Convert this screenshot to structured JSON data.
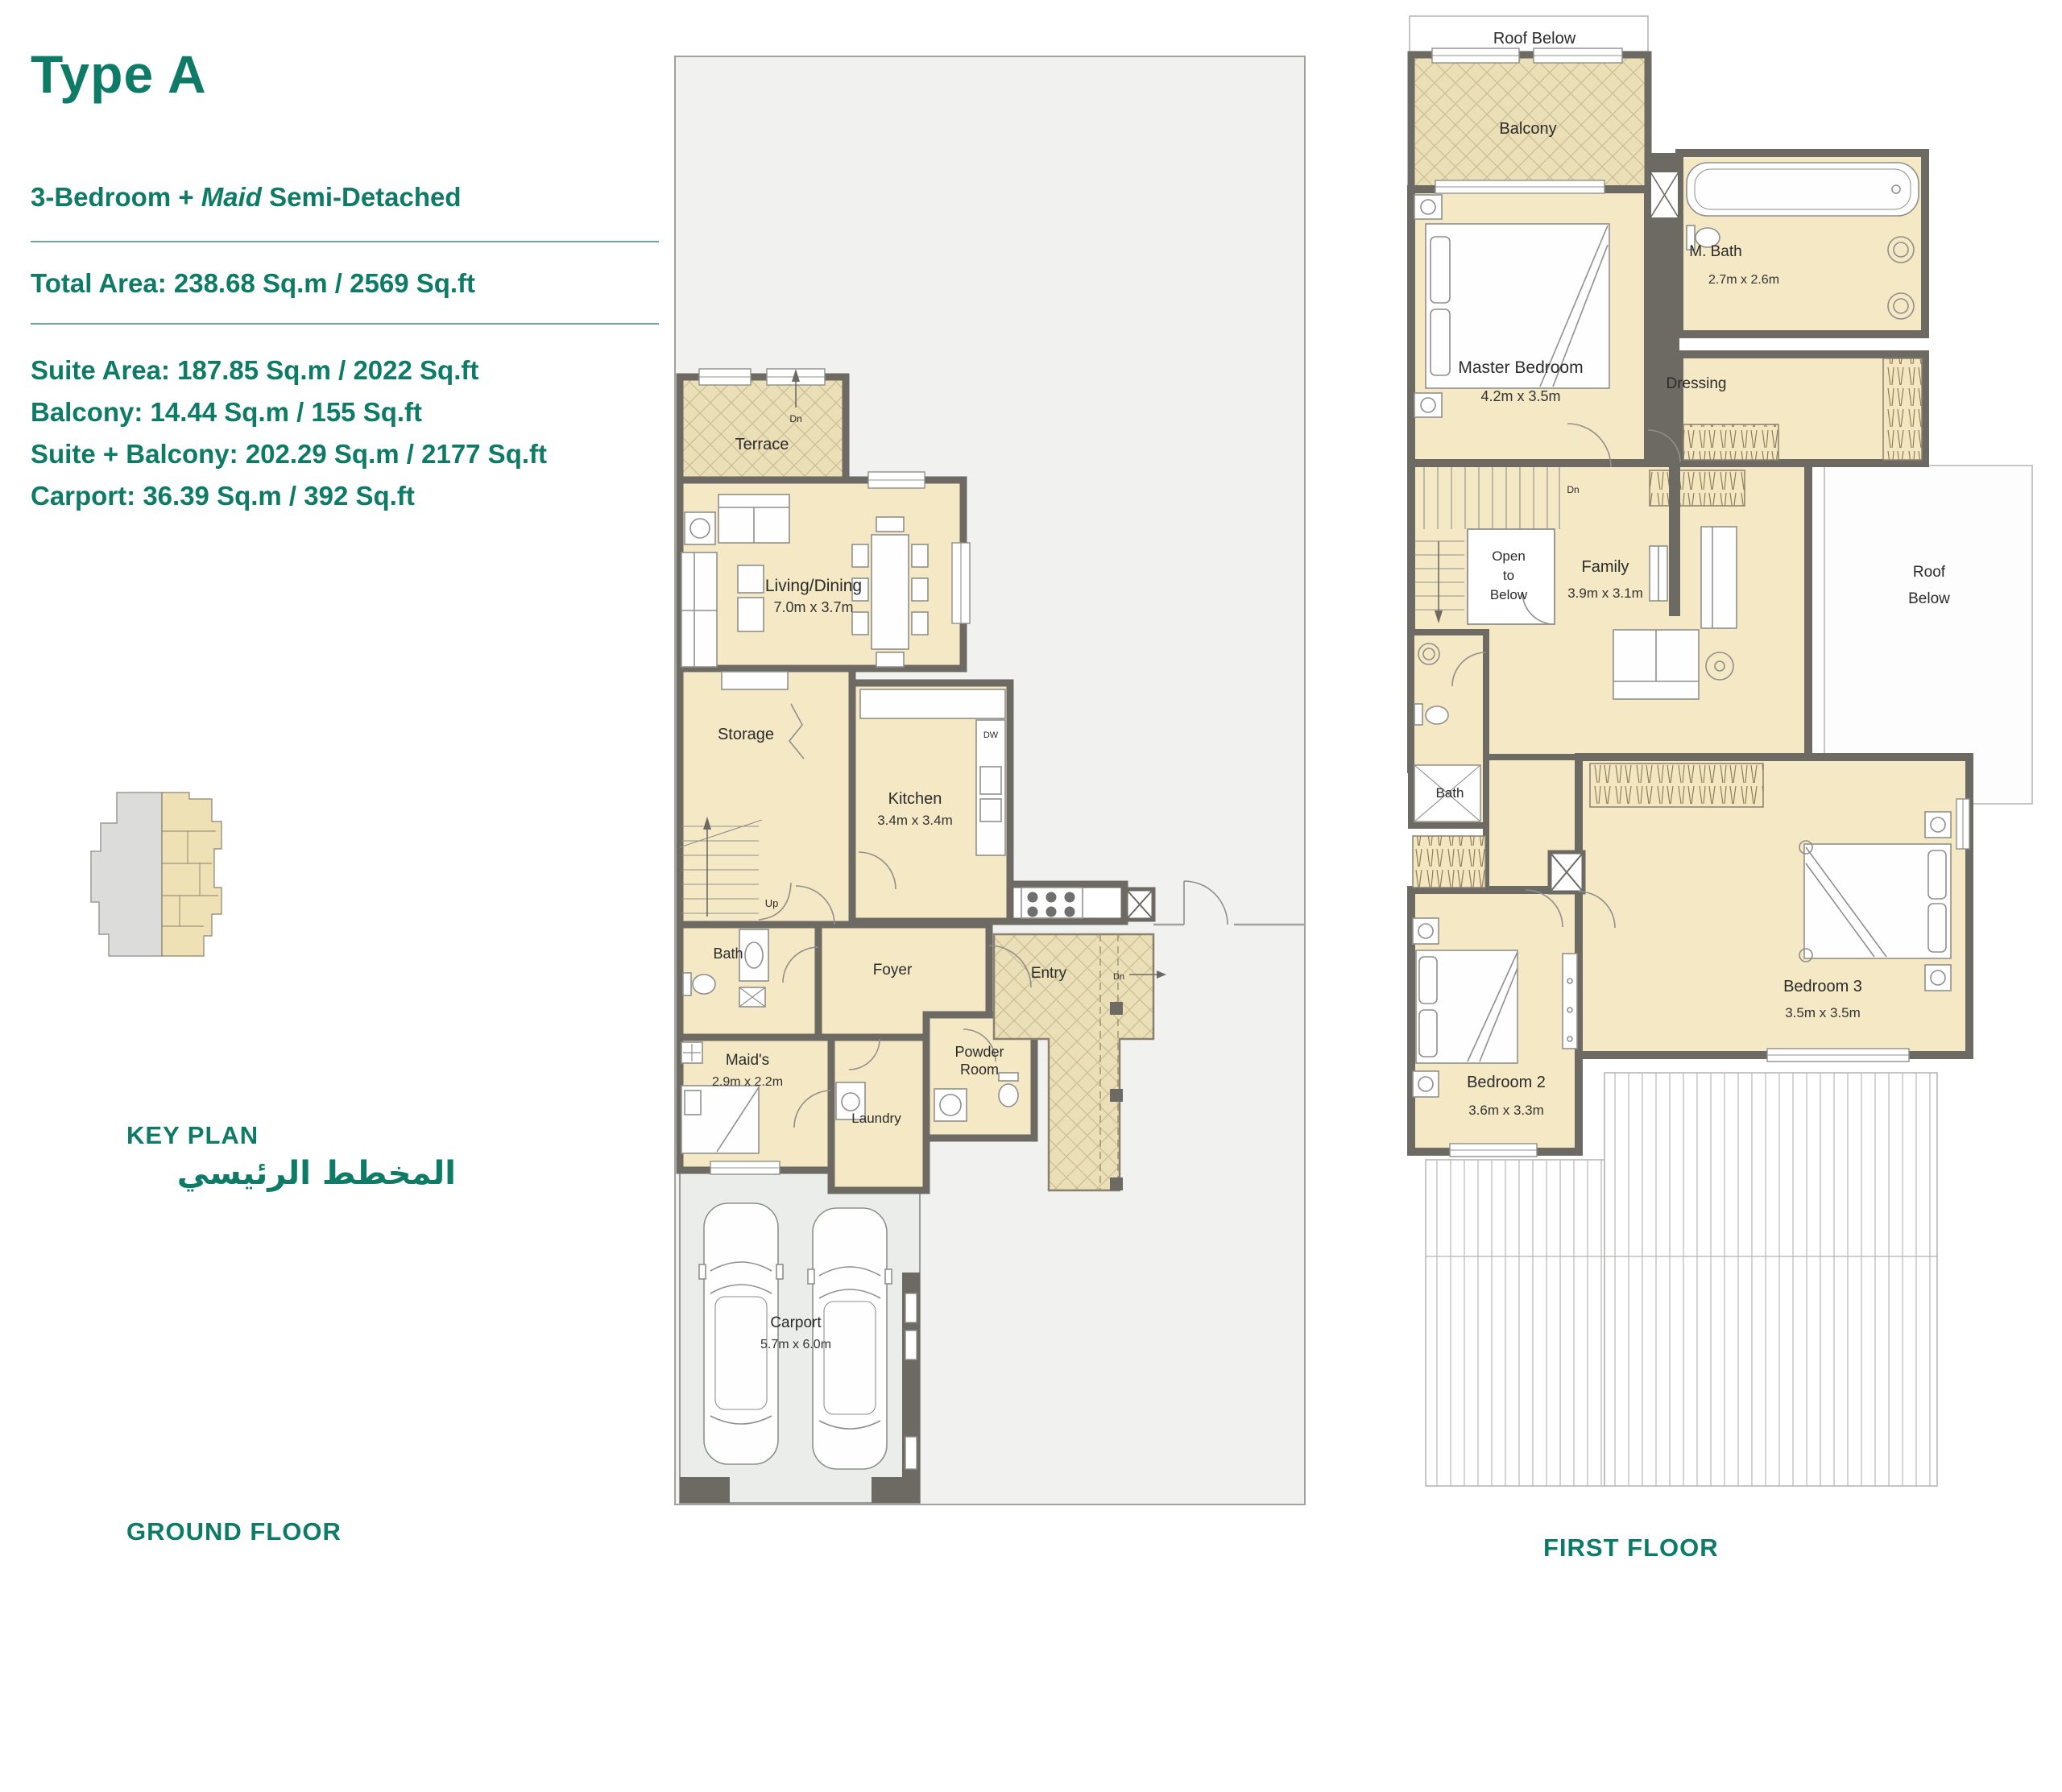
{
  "header": {
    "title": "Type A",
    "subtitle_prefix": "3-Bedroom + ",
    "subtitle_italic": "Maid",
    "subtitle_suffix": " Semi-Detached",
    "total_area": "Total Area: 238.68 Sq.m / 2569 Sq.ft",
    "areas": [
      "Suite Area: 187.85 Sq.m / 2022 Sq.ft",
      "Balcony: 14.44 Sq.m / 155 Sq.ft",
      "Suite + Balcony: 202.29 Sq.m / 2177 Sq.ft",
      "Carport: 36.39 Sq.m / 392 Sq.ft"
    ]
  },
  "key_plan": {
    "label": "KEY PLAN",
    "label_ar": "المخطط الرئيسي"
  },
  "ground": {
    "floor_label": "GROUND FLOOR",
    "terrace": "Terrace",
    "living": "Living/Dining",
    "living_dims": "7.0m x 3.7m",
    "storage": "Storage",
    "kitchen": "Kitchen",
    "kitchen_dims": "3.4m x 3.4m",
    "bath": "Bath",
    "foyer": "Foyer",
    "entry": "Entry",
    "maids": "Maid's",
    "maids_dims": "2.9m x 2.2m",
    "powder_1": "Powder",
    "powder_2": "Room",
    "laundry": "Laundry",
    "carport": "Carport",
    "carport_dims": "5.7m x 6.0m",
    "dn": "Dn",
    "up": "Up",
    "dw": "DW"
  },
  "first": {
    "floor_label": "FIRST FLOOR",
    "roof_below_top": "Roof Below",
    "balcony": "Balcony",
    "master": "Master Bedroom",
    "master_dims": "4.2m x 3.5m",
    "mbath": "M. Bath",
    "mbath_dims": "2.7m x 2.6m",
    "dressing": "Dressing",
    "open_1": "Open",
    "open_2": "to",
    "open_3": "Below",
    "family": "Family",
    "family_dims": "3.9m x 3.1m",
    "bath": "Bath",
    "bed2": "Bedroom 2",
    "bed2_dims": "3.6m x 3.3m",
    "bed3": "Bedroom 3",
    "bed3_dims": "3.5m x 3.5m",
    "roof_right_1": "Roof",
    "roof_right_2": "Below",
    "dn": "Dn"
  },
  "colors": {
    "teal": "#0e7b66",
    "wall": "#6d6a64",
    "room_fill": "#f5e8c4",
    "hatch_fill": "#eadfb6",
    "plot_fill": "#f1f1ef",
    "carport_fill": "#eaede9"
  }
}
